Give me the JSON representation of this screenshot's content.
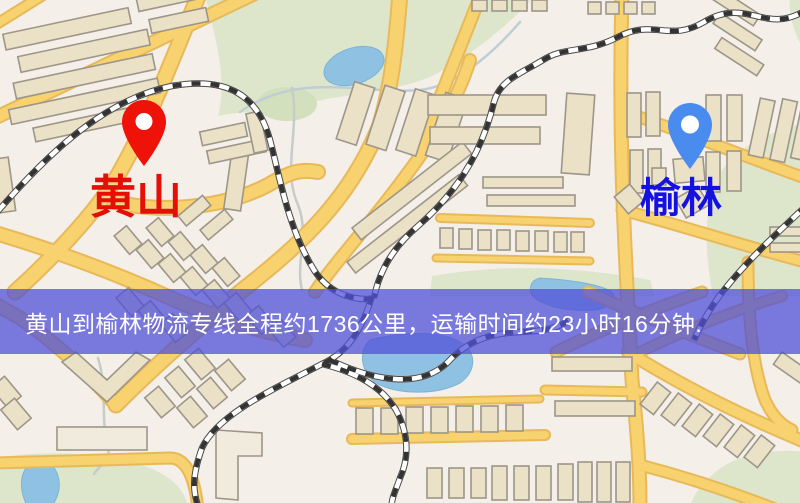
{
  "map": {
    "origin": {
      "label": "黄山",
      "pin_color": "#ee1208",
      "label_color": "#e50f08"
    },
    "destination": {
      "label": "榆林",
      "pin_color": "#4a8bf0",
      "label_color": "#1512e0"
    }
  },
  "banner": {
    "text": "黄山到榆林物流专线全程约1736公里，运输时间约23小时16分钟.",
    "background_color": "rgba(80,80,215,0.75)",
    "text_color": "#ffffff"
  },
  "map_palette": {
    "background": "#f4efe9",
    "park_green": "#dde6cb",
    "water_blue": "#8fc2e2",
    "road_yellow": "#f8d26e",
    "road_casing": "#e7b95a",
    "railway_dash": "#333333",
    "building_fill": "#eae1c6",
    "building_stroke": "#9d9689"
  }
}
